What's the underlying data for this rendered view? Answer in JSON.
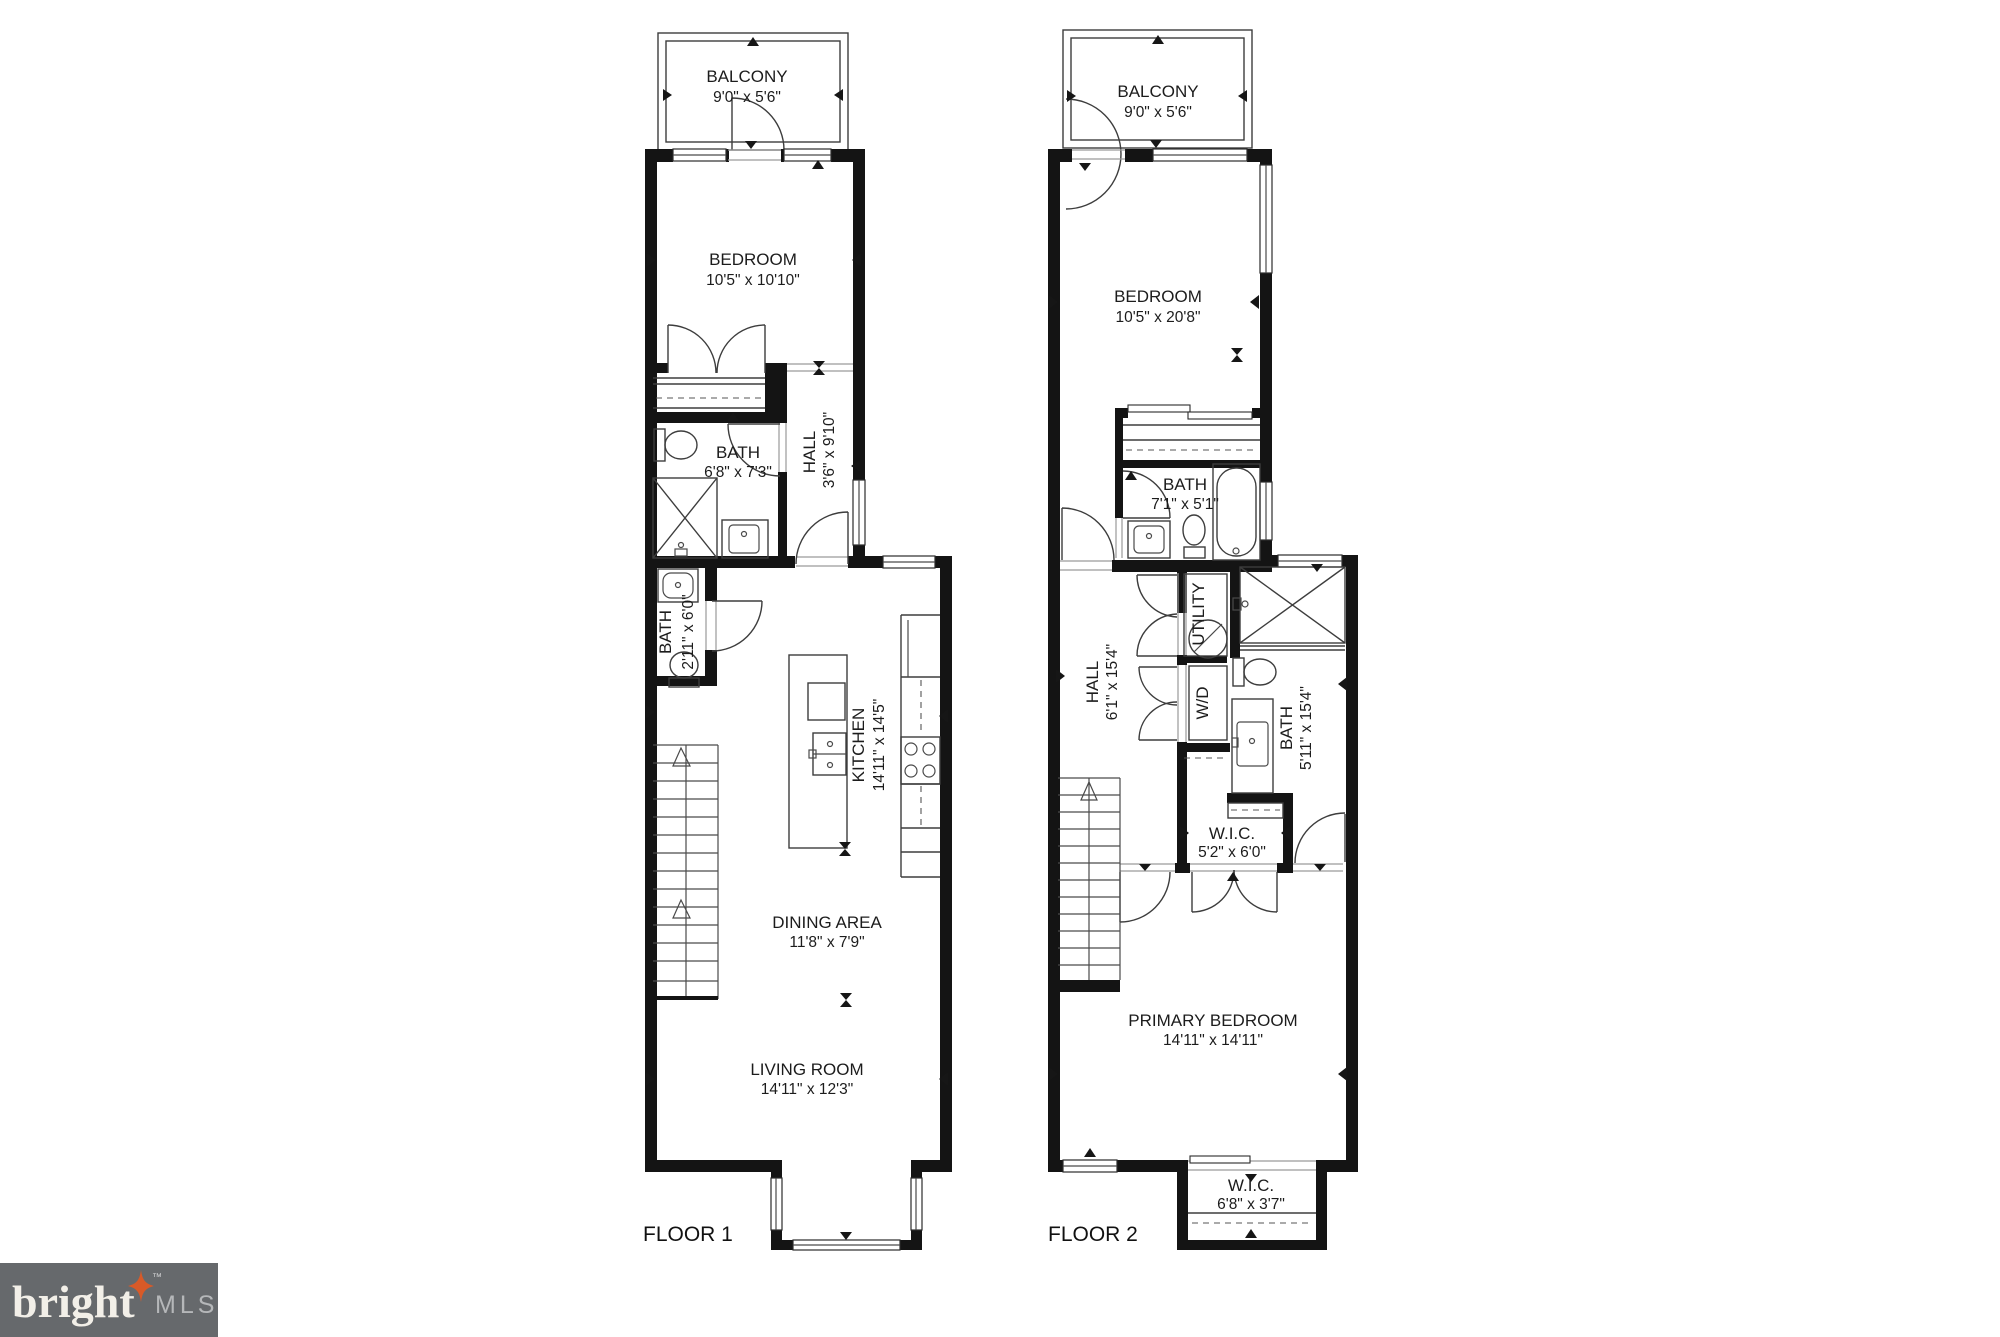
{
  "brand": {
    "name": "bright",
    "suffix": "MLS",
    "tm": "™",
    "bg_color": "#66696c",
    "star_color": "#d85a28",
    "name_color": "#f2efe8",
    "mls_color": "#b5b7b9"
  },
  "floor1": {
    "label": "FLOOR 1",
    "balcony": {
      "name": "BALCONY",
      "dims": "9'0\" x 5'6\""
    },
    "bedroom": {
      "name": "BEDROOM",
      "dims": "10'5\" x 10'10\""
    },
    "bath": {
      "name": "BATH",
      "dims": "6'8\" x 7'3\""
    },
    "hall": {
      "name": "HALL",
      "dims": "3'6\" x 9'10\""
    },
    "powder": {
      "name": "BATH",
      "dims": "2'11\" x 6'0\""
    },
    "kitchen": {
      "name": "KITCHEN",
      "dims": "14'11\" x 14'5\""
    },
    "dining": {
      "name": "DINING AREA",
      "dims": "11'8\" x 7'9\""
    },
    "living": {
      "name": "LIVING ROOM",
      "dims": "14'11\" x 12'3\""
    }
  },
  "floor2": {
    "label": "FLOOR 2",
    "balcony": {
      "name": "BALCONY",
      "dims": "9'0\" x 5'6\""
    },
    "bedroom": {
      "name": "BEDROOM",
      "dims": "10'5\" x 20'8\""
    },
    "bath_upper": {
      "name": "BATH",
      "dims": "7'1\" x 5'1\""
    },
    "hall": {
      "name": "HALL",
      "dims": "6'1\" x 15'4\""
    },
    "utility": {
      "name": "UTILITY"
    },
    "wd": {
      "name": "W/D"
    },
    "bath_main": {
      "name": "BATH",
      "dims": "5'11\" x 15'4\""
    },
    "wic_hall": {
      "name": "W.I.C.",
      "dims": "5'2\" x 6'0\""
    },
    "primary": {
      "name": "PRIMARY BEDROOM",
      "dims": "14'11\" x 14'11\""
    },
    "wic_lower": {
      "name": "W.I.C.",
      "dims": "6'8\" x 3'7\""
    }
  }
}
